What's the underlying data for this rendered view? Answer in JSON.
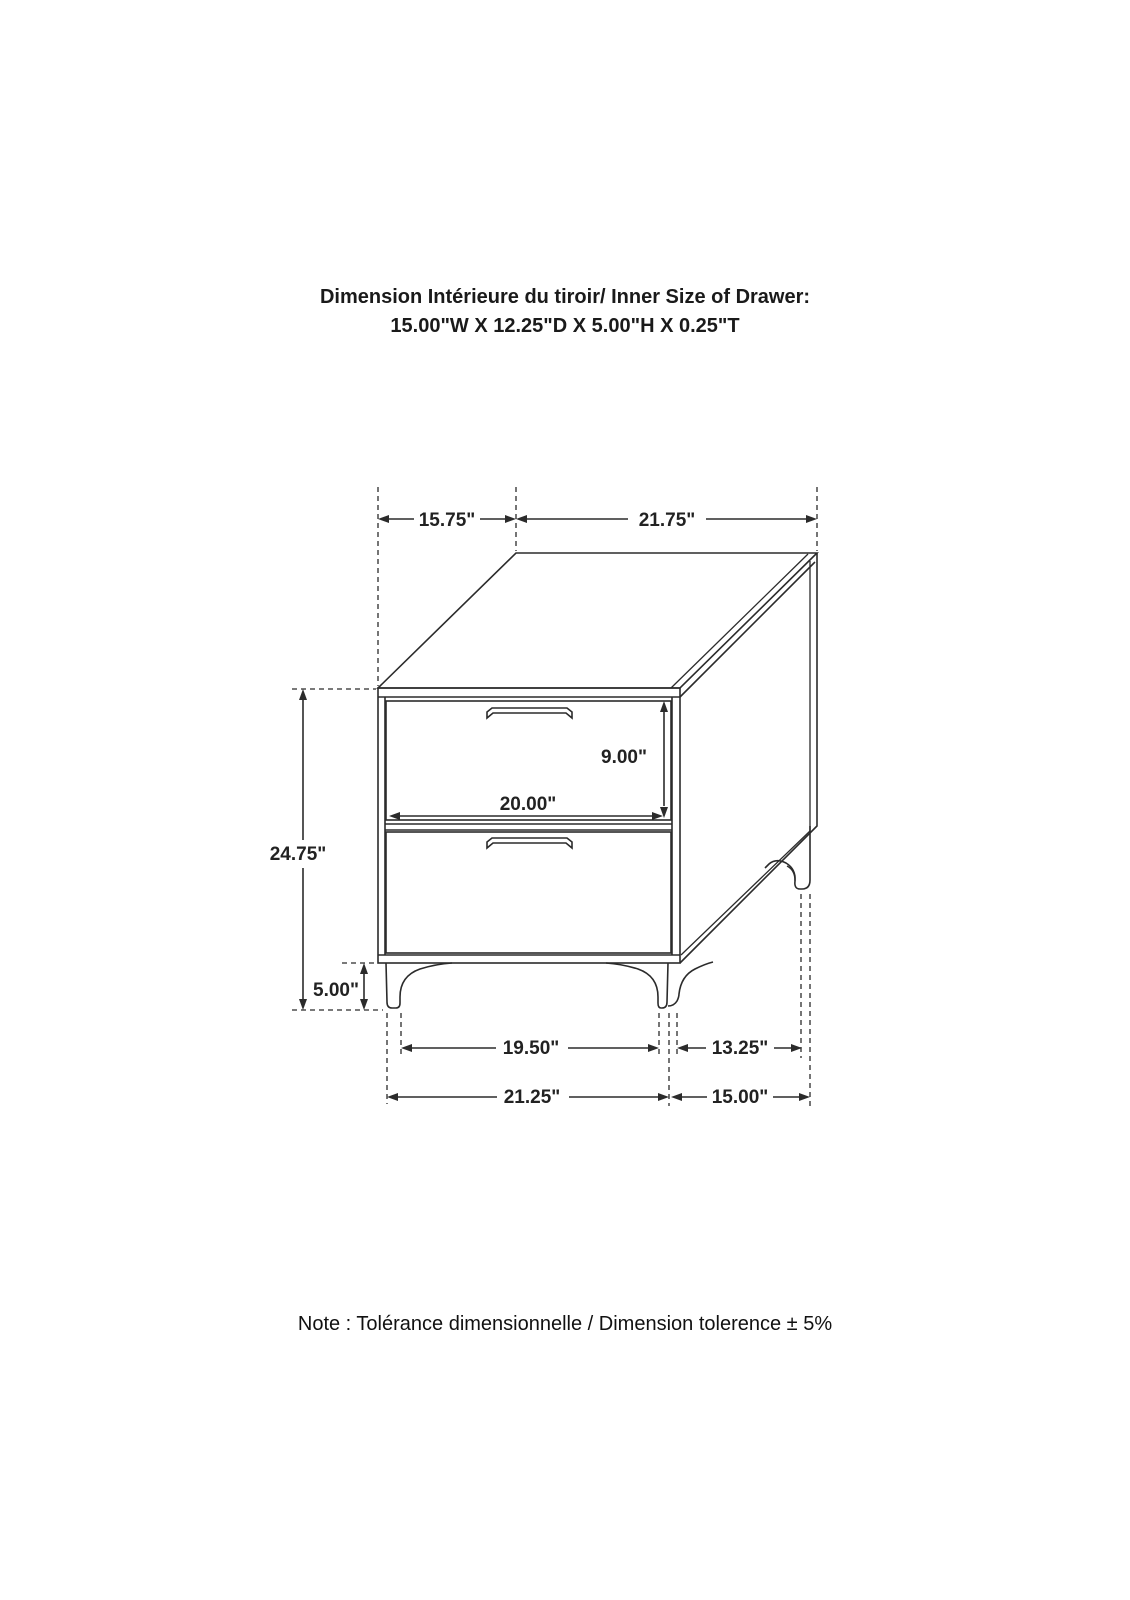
{
  "header": {
    "line1": "Dimension Intérieure du tiroir/ Inner Size of Drawer:",
    "line2": "15.00\"W X 12.25\"D X 5.00\"H X 0.25\"T"
  },
  "note": {
    "text": "Note : Tolérance dimensionnelle / Dimension tolerence  ± 5%"
  },
  "dimensions": {
    "depth_top": "15.75\"",
    "width_top": "21.75\"",
    "overall_height": "24.75\"",
    "drawer_height": "9.00\"",
    "drawer_width": "20.00\"",
    "leg_height": "5.00\"",
    "front_feet_inner_span": "19.50\"",
    "side_feet_inner_span": "13.25\"",
    "front_feet_outer_span": "21.25\"",
    "side_feet_outer_span": "15.00\""
  },
  "colors": {
    "ink": "#2b2b2b",
    "text": "#1a1a1a",
    "background": "#ffffff"
  }
}
